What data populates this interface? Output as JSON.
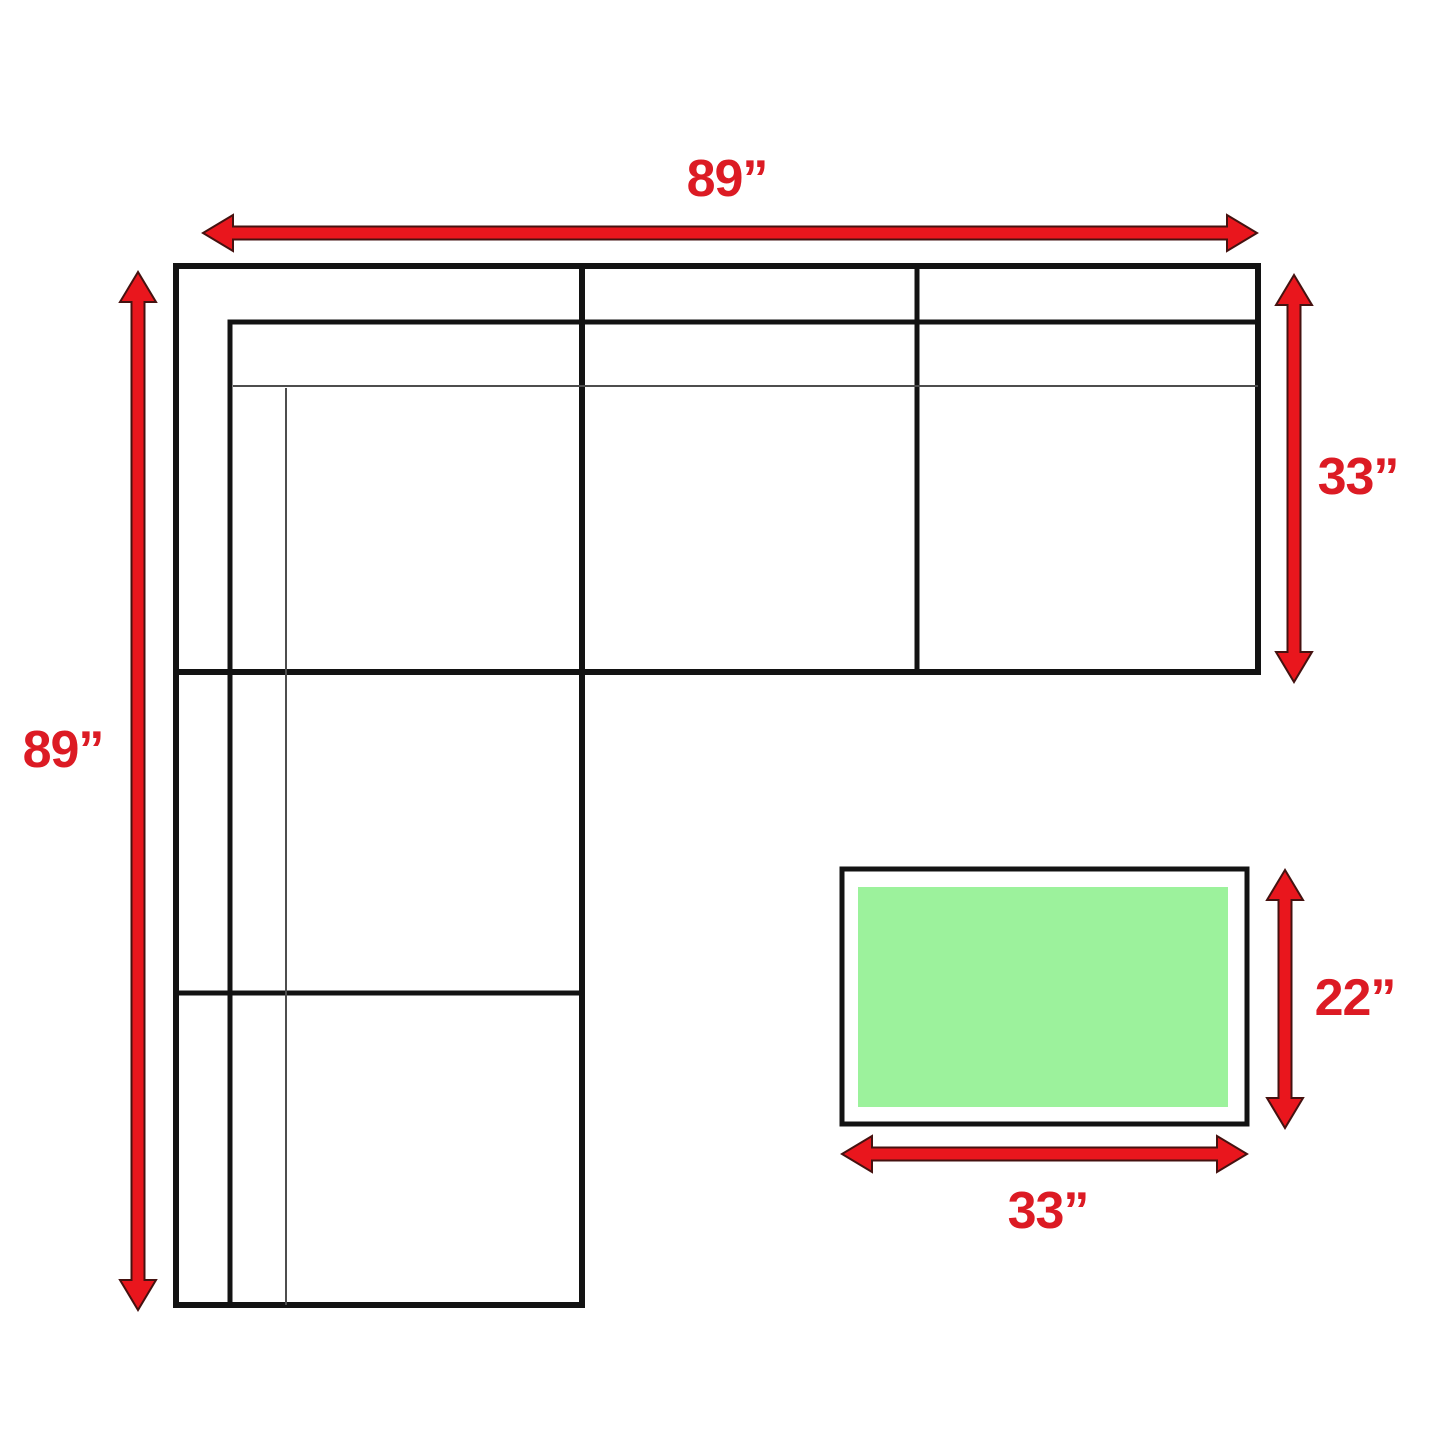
{
  "sofa": {
    "width_label": "89”",
    "length_label": "89”",
    "depth_label": "33”"
  },
  "ottoman": {
    "width_label": "33”",
    "depth_label": "22”"
  },
  "colors": {
    "dimension_red": "#e9161d",
    "arrow_outline": "#451210",
    "label_red": "#dc1b24",
    "outline_black": "#131313",
    "thin_line_gray": "#4d4d4d",
    "ottoman_green": "#9cf29c"
  }
}
